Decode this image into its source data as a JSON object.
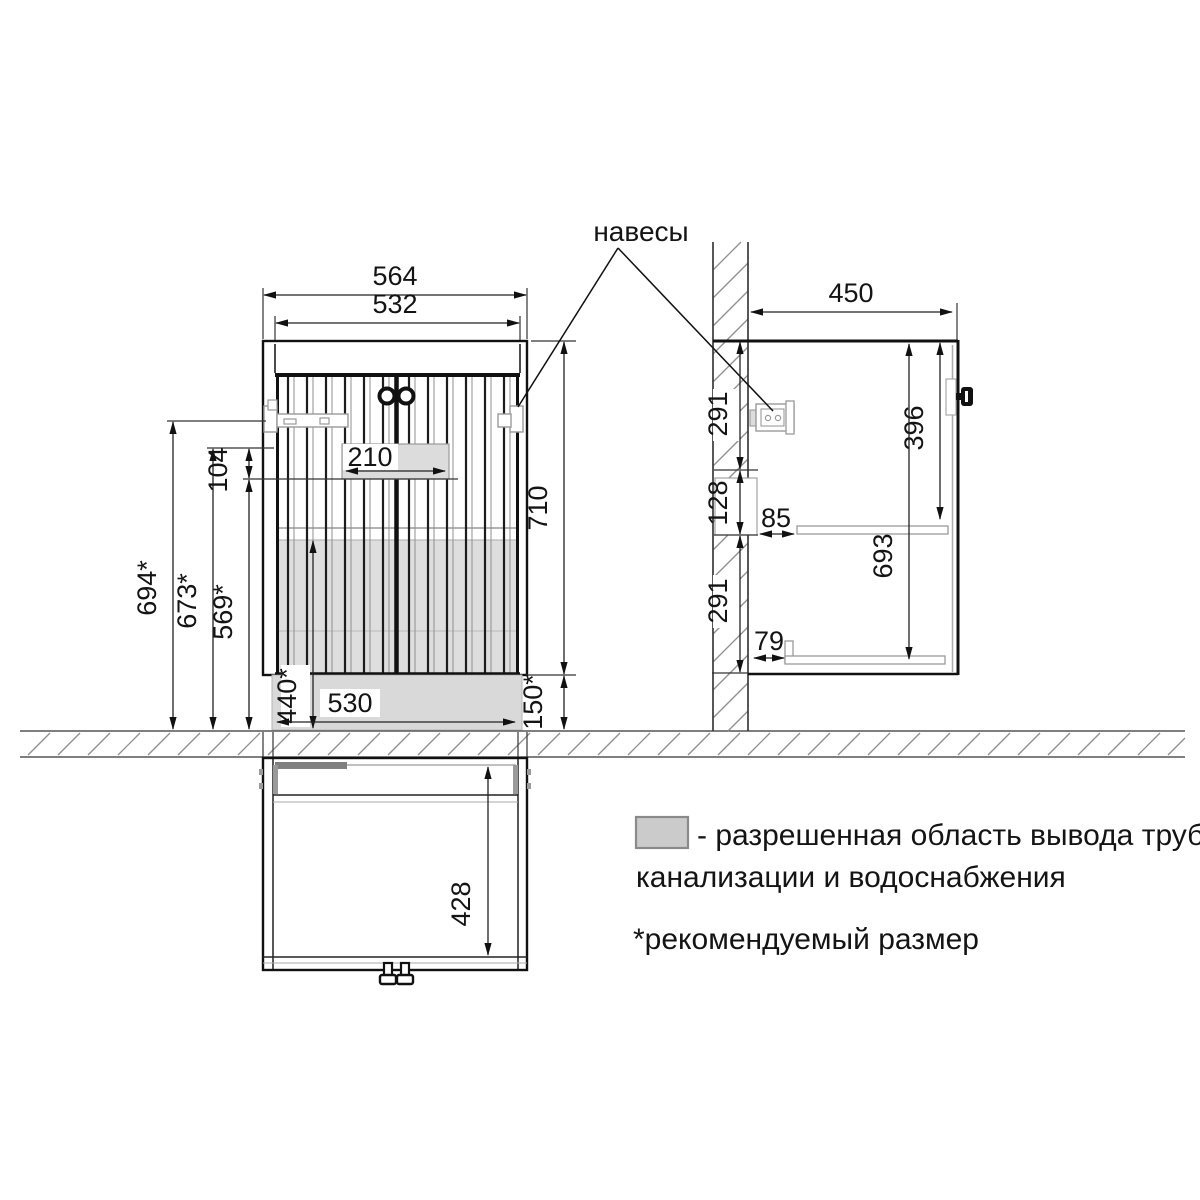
{
  "labels": {
    "hinges": "навесы"
  },
  "front": {
    "w_outer": "564",
    "w_door": "532",
    "pipe_w": "210",
    "pipe_h": "104",
    "h_hinge": "694*",
    "h_pipe_top": "673*",
    "h_pipe_bot": "569*",
    "h_pipe_zone": "440*",
    "w_bottom": "530",
    "h_cab": "710",
    "h_gap": "150*"
  },
  "side": {
    "depth": "450",
    "z_top": "291",
    "z_mid": "128",
    "z_bot": "291",
    "h_door": "396",
    "h_inner": "693",
    "off_shelf": "85",
    "off_rail": "79"
  },
  "bottom": {
    "depth_inner": "428"
  },
  "legend": {
    "swatch_color": "#cbcbcb",
    "line1": "- разрешенная область вывода труб",
    "line2": "канализации и водоснабжения",
    "note": "*рекомендуемый размер"
  },
  "colors": {
    "pipe_area": "#d9d9d9",
    "line": "#111111"
  }
}
